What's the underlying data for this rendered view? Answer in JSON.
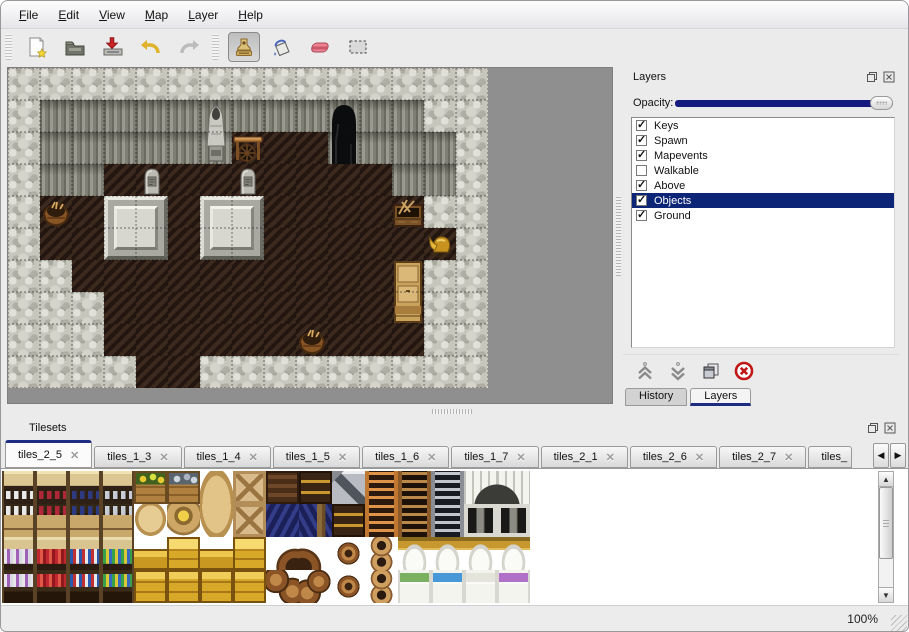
{
  "menu": {
    "items": [
      {
        "label": "File",
        "mnemonic": "F"
      },
      {
        "label": "Edit",
        "mnemonic": "E"
      },
      {
        "label": "View",
        "mnemonic": "V"
      },
      {
        "label": "Map",
        "mnemonic": "M"
      },
      {
        "label": "Layer",
        "mnemonic": "L"
      },
      {
        "label": "Help",
        "mnemonic": "H"
      }
    ]
  },
  "toolbar": {
    "buttons": [
      "new",
      "open",
      "save",
      "undo",
      "redo",
      "stamp",
      "fill",
      "eraser",
      "select"
    ],
    "active_tool": "stamp"
  },
  "layers_panel": {
    "title": "Layers",
    "opacity_label": "Opacity:",
    "opacity_value": 100,
    "layers": [
      {
        "name": "Keys",
        "checked": true,
        "selected": false
      },
      {
        "name": "Spawn",
        "checked": true,
        "selected": false
      },
      {
        "name": "Mapevents",
        "checked": true,
        "selected": false
      },
      {
        "name": "Walkable",
        "checked": false,
        "selected": false
      },
      {
        "name": "Above",
        "checked": true,
        "selected": false
      },
      {
        "name": "Objects",
        "checked": true,
        "selected": true
      },
      {
        "name": "Ground",
        "checked": true,
        "selected": false
      }
    ],
    "buttons": [
      "move-layer-up",
      "move-layer-down",
      "duplicate-layer",
      "delete-layer"
    ],
    "tabs": [
      {
        "label": "History",
        "active": false
      },
      {
        "label": "Layers",
        "active": true
      }
    ]
  },
  "tilesets_panel": {
    "title": "Tilesets",
    "tabs": [
      {
        "label": "tiles_2_5",
        "active": true,
        "partial": false
      },
      {
        "label": "tiles_1_3",
        "active": false,
        "partial": false
      },
      {
        "label": "tiles_1_4",
        "active": false,
        "partial": false
      },
      {
        "label": "tiles_1_5",
        "active": false,
        "partial": false
      },
      {
        "label": "tiles_1_6",
        "active": false,
        "partial": false
      },
      {
        "label": "tiles_1_7",
        "active": false,
        "partial": false
      },
      {
        "label": "tiles_2_1",
        "active": false,
        "partial": false
      },
      {
        "label": "tiles_2_6",
        "active": false,
        "partial": false
      },
      {
        "label": "tiles_2_7",
        "active": false,
        "partial": false
      },
      {
        "label": "tiles_",
        "active": false,
        "partial": true
      }
    ],
    "close_glyph": "✕",
    "scroll_left_glyph": "◀",
    "scroll_right_glyph": "▶",
    "grid": [
      [
        "sht c1",
        "sht c2",
        "sht c3",
        "sht c4",
        "cveg",
        "cfish",
        "sk1",
        "cx",
        "cslat",
        "cgold",
        "metz",
        "lo",
        "lb",
        "lg",
        "dtl",
        "dtr"
      ],
      [
        "shb c1",
        "shb c2",
        "shb c3",
        "shb c4",
        "sk2",
        "sk3",
        "sk4",
        "cx",
        "tarp",
        "tarp2",
        "cgold",
        "lo",
        "lb",
        "lg",
        "dbl",
        "dbr"
      ],
      [
        "sh2 c5",
        "sh2 c6",
        "sh2 c7",
        "sh2 c8",
        "ycC",
        "ycB",
        "ycC",
        "ycB",
        "bp1",
        "bp2",
        "bar",
        "pots",
        "bedt",
        "bedt",
        "bedt",
        "bedt"
      ],
      [
        "sh2b c5",
        "sh2b c6",
        "sh2b c7",
        "sh2b c8",
        "ycA",
        "ycA",
        "ycA",
        "ycA",
        "bp3",
        "bp4",
        "bar",
        "pots",
        "bedbot bedg",
        "bedbot bedb",
        "bedbot bedw",
        "bedbot bedp"
      ]
    ]
  },
  "map": {
    "cols": 15,
    "rows": 10,
    "tile_size": 32,
    "terrain": [
      "RRRRRRRRRRRRRRR",
      "RCCCCCCCCCCCCRR",
      "RCCCCCCFFFCCCCR",
      "RCCFFFFFFFFFCCR",
      "RFFFFFFFFFFFFRR",
      "RFFFFFFFFFFFFFR",
      "RRFFFFFFFFFFFRR",
      "RRRFFFFFFFFFFRR",
      "RRRFFFFFFFFFFRR",
      "RRRRFFRRRRRRRRR"
    ],
    "objects": [
      {
        "type": "platform",
        "col": 3,
        "row": 4,
        "w": 2,
        "h": 2
      },
      {
        "type": "platform",
        "col": 6,
        "row": 4,
        "w": 2,
        "h": 2
      },
      {
        "type": "gravestone",
        "col": 4,
        "row": 3,
        "w": 1,
        "h": 1
      },
      {
        "type": "gravestone",
        "col": 7,
        "row": 3,
        "w": 1,
        "h": 1
      },
      {
        "type": "statue",
        "col": 6,
        "row": 1,
        "w": 1,
        "h": 2
      },
      {
        "type": "table",
        "col": 7,
        "row": 2,
        "w": 1,
        "h": 1
      },
      {
        "type": "cave",
        "col": 10,
        "row": 1,
        "w": 1,
        "h": 2
      },
      {
        "type": "basket",
        "col": 1,
        "row": 4,
        "w": 1,
        "h": 1
      },
      {
        "type": "toolcrate",
        "col": 12,
        "row": 4,
        "w": 1,
        "h": 1
      },
      {
        "type": "helmet",
        "col": 13,
        "row": 5,
        "w": 1,
        "h": 1
      },
      {
        "type": "cabinet",
        "col": 12,
        "row": 6,
        "w": 1,
        "h": 2
      },
      {
        "type": "basket",
        "col": 9,
        "row": 8,
        "w": 1,
        "h": 1
      }
    ]
  },
  "status": {
    "zoom_label": "100%"
  },
  "colors": {
    "selection_blue": "#0d2577",
    "slider_track": "#151a7e",
    "map_background": "#8f8f8f",
    "chrome": "#ebebeb"
  }
}
